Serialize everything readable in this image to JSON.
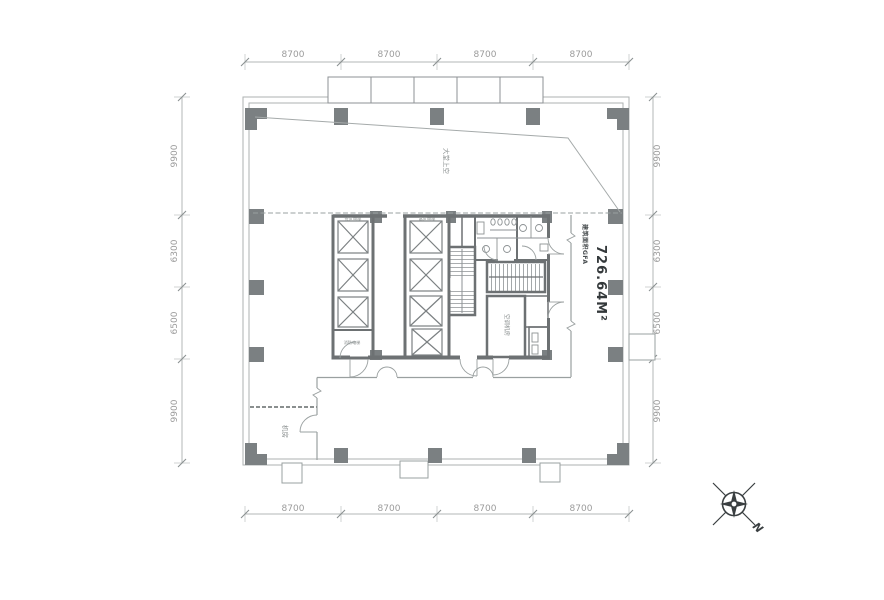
{
  "drawing": {
    "type": "architectural-floor-plan",
    "area_caption": "建筑面积GFA",
    "area_value": "726.64M²"
  },
  "dims": {
    "top": [
      "8700",
      "8700",
      "8700",
      "8700"
    ],
    "bottom": [
      "8700",
      "8700",
      "8700",
      "8700"
    ],
    "left": [
      "9900",
      "6300",
      "6500",
      "9900"
    ],
    "right": [
      "9900",
      "6300",
      "6500",
      "9900"
    ]
  },
  "labels": {
    "lobby_void": "大堂上空",
    "machine_room": "机房",
    "bank_low": "低区电梯",
    "bank_high": "高区电梯",
    "fire_lift": "消防电梯",
    "ahu_room": "空调机房",
    "north": "N"
  },
  "colors": {
    "wall": "#6d7173",
    "column": "#7b8082",
    "thin_line": "#a9aeae",
    "boundary_line": "#9aa0a0",
    "dim_text": "#9b9b9b",
    "area_text": "#34393b"
  }
}
